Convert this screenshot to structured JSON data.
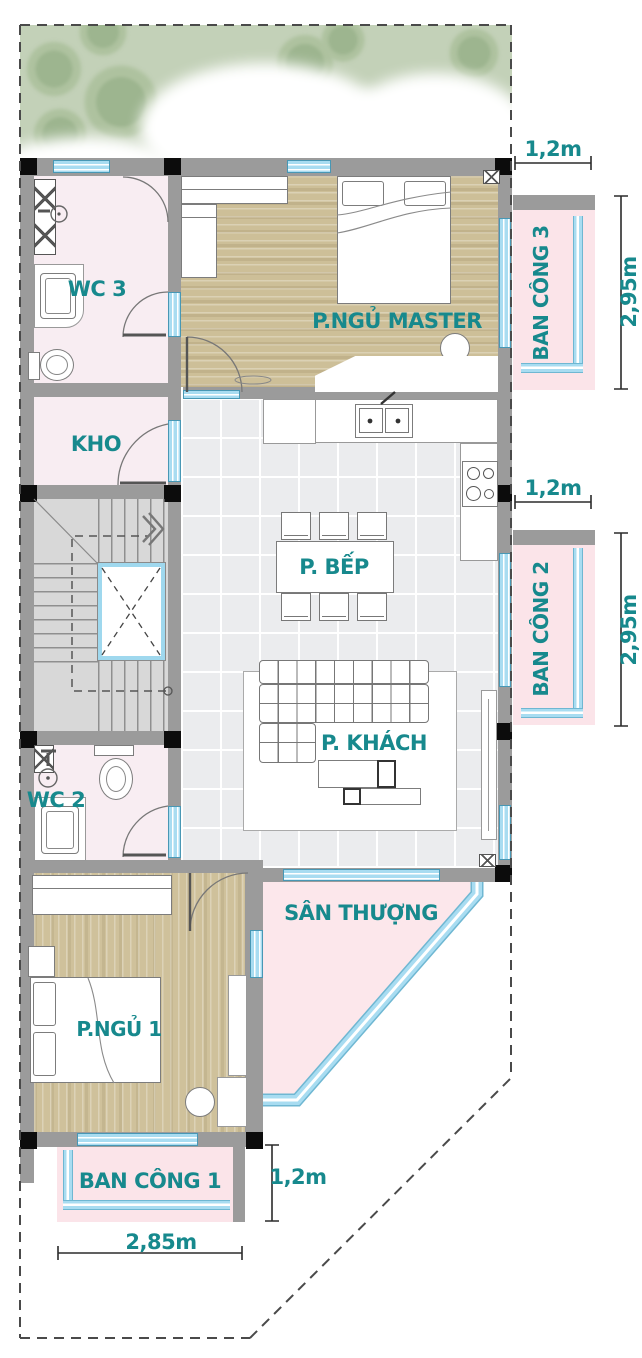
{
  "title": "Floor plan",
  "labels": {
    "wc3": "WC 3",
    "kho": "KHO",
    "master": "P.NGỦ MASTER",
    "bancong3": "BAN CÔNG 3",
    "bep": "P. BẾP",
    "bancong2": "BAN CÔNG 2",
    "wc2": "WC 2",
    "khach": "P. KHÁCH",
    "santhuong": "SÂN THƯỢNG",
    "ngu1": "P.NGỦ 1",
    "bancong1": "BAN CÔNG 1"
  },
  "dimensions": {
    "balcony3_width": "1,2m",
    "balcony3_depth": "2,95m",
    "balcony2_width": "1,2m",
    "balcony2_depth": "2,95m",
    "balcony1_depth": "1,2m",
    "balcony1_width": "2,85m"
  },
  "colors": {
    "label_teal": "#17898d",
    "room_pink": "#f8edf2",
    "balcony_pink": "#fbe4e9",
    "terrace_pink": "#fce7eb",
    "wood_floor": "#cdbf98",
    "tile_floor": "#ebecee",
    "stair_gray": "#d8d8d8",
    "wall_gray": "#9b9b9b",
    "column_black": "#0c0c0c",
    "window_blue": "#a8dcf1",
    "tree_green": "#c3d1b8"
  }
}
